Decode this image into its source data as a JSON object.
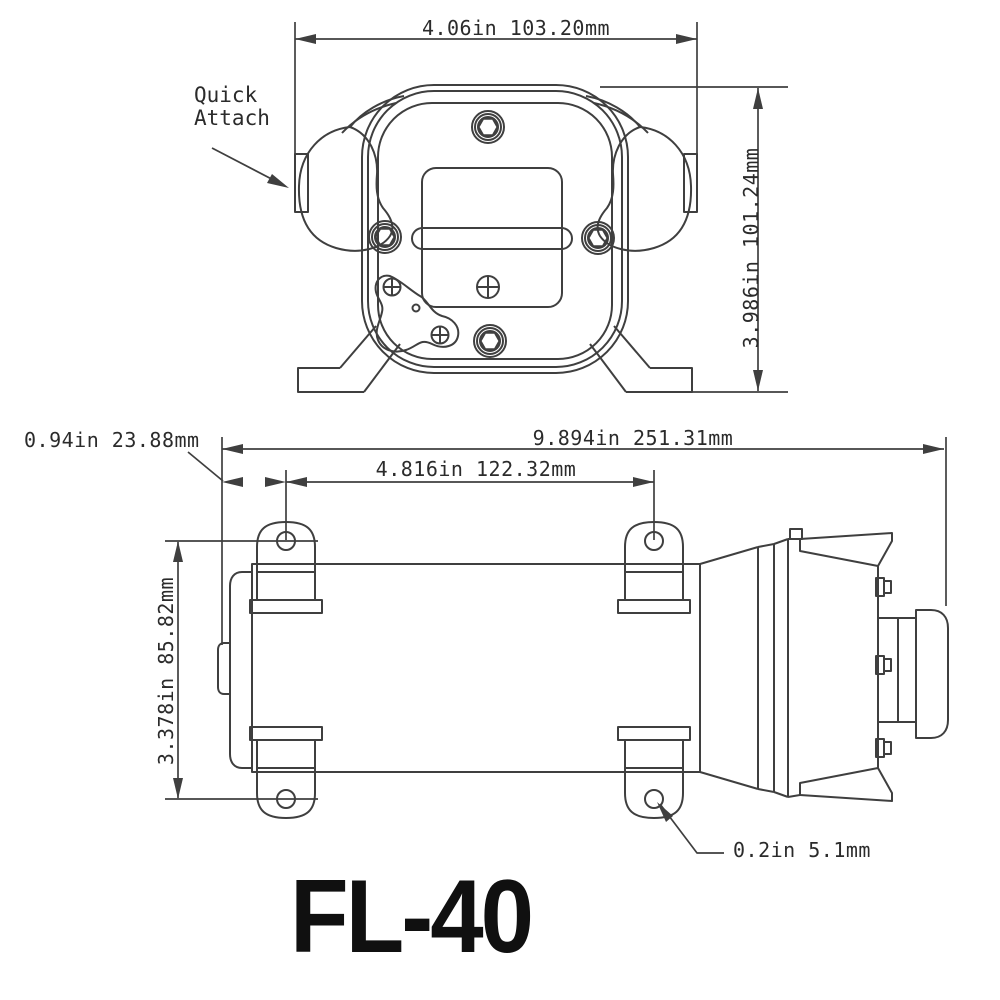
{
  "diagram": {
    "title_model": "FL-40",
    "front_view": {
      "width_dim": "4.06in 103.20mm",
      "height_dim": "3.986in 101.24mm",
      "callout": "Quick\nAttach"
    },
    "side_view": {
      "offset_dim": "0.94in 23.88mm",
      "overall_length_dim": "9.894in 251.31mm",
      "hole_spacing_dim": "4.816in 122.32mm",
      "height_dim": "3.378in 85.82mm",
      "hole_diameter_dim": "0.2in 5.1mm"
    },
    "colors": {
      "line": "#3f3f3f",
      "text": "#2b2b2b",
      "background": "#ffffff"
    }
  }
}
